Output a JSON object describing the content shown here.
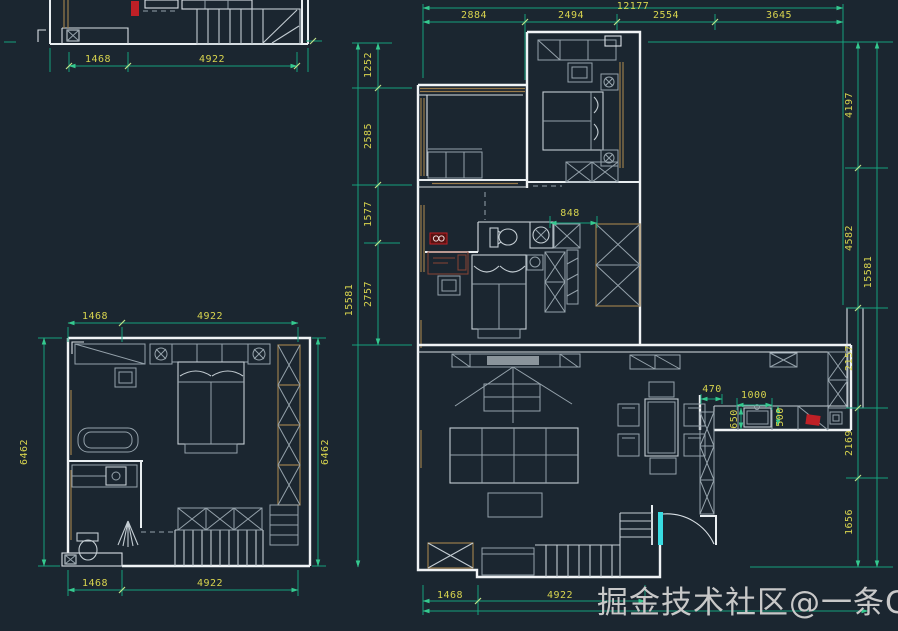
{
  "watermark": {
    "text": "掘金技术社区@一条Go"
  },
  "colors": {
    "background": "#1b2630",
    "wall": "#e9eef1",
    "furniture": "#95a2ab",
    "window_frame": "#9a7c4c",
    "dimension_line": "#16a07c",
    "dimension_text": "#d8d44e",
    "accent_red": "#bf2026",
    "accent_cyan": "#39dce2",
    "watermark_text": "#c8c8c8"
  },
  "plan_upper_left": {
    "dims_bottom": [
      "1468",
      "4922"
    ]
  },
  "plan_lower_left": {
    "dims_top": [
      "1468",
      "4922"
    ],
    "dims_bottom": [
      "1468",
      "4922"
    ],
    "dim_left": "6462",
    "dim_right": "6462"
  },
  "plan_right": {
    "dim_total_top": "12177",
    "dims_top": [
      "2884",
      "2494",
      "2554",
      "3645"
    ],
    "dims_left": [
      "1252",
      "2585",
      "1577",
      "2757"
    ],
    "dim_total_left": "15581",
    "dims_right": [
      "4197",
      "4582",
      "2157",
      "2169",
      "1656"
    ],
    "dim_total_right": "15581",
    "dims_bottom": [
      "1468",
      "4922"
    ],
    "dim_bathroom": "848",
    "dims_kitchen": {
      "opening": "470",
      "counter_run": "1000",
      "counter_depth": "650",
      "sink_depth": "500"
    }
  }
}
